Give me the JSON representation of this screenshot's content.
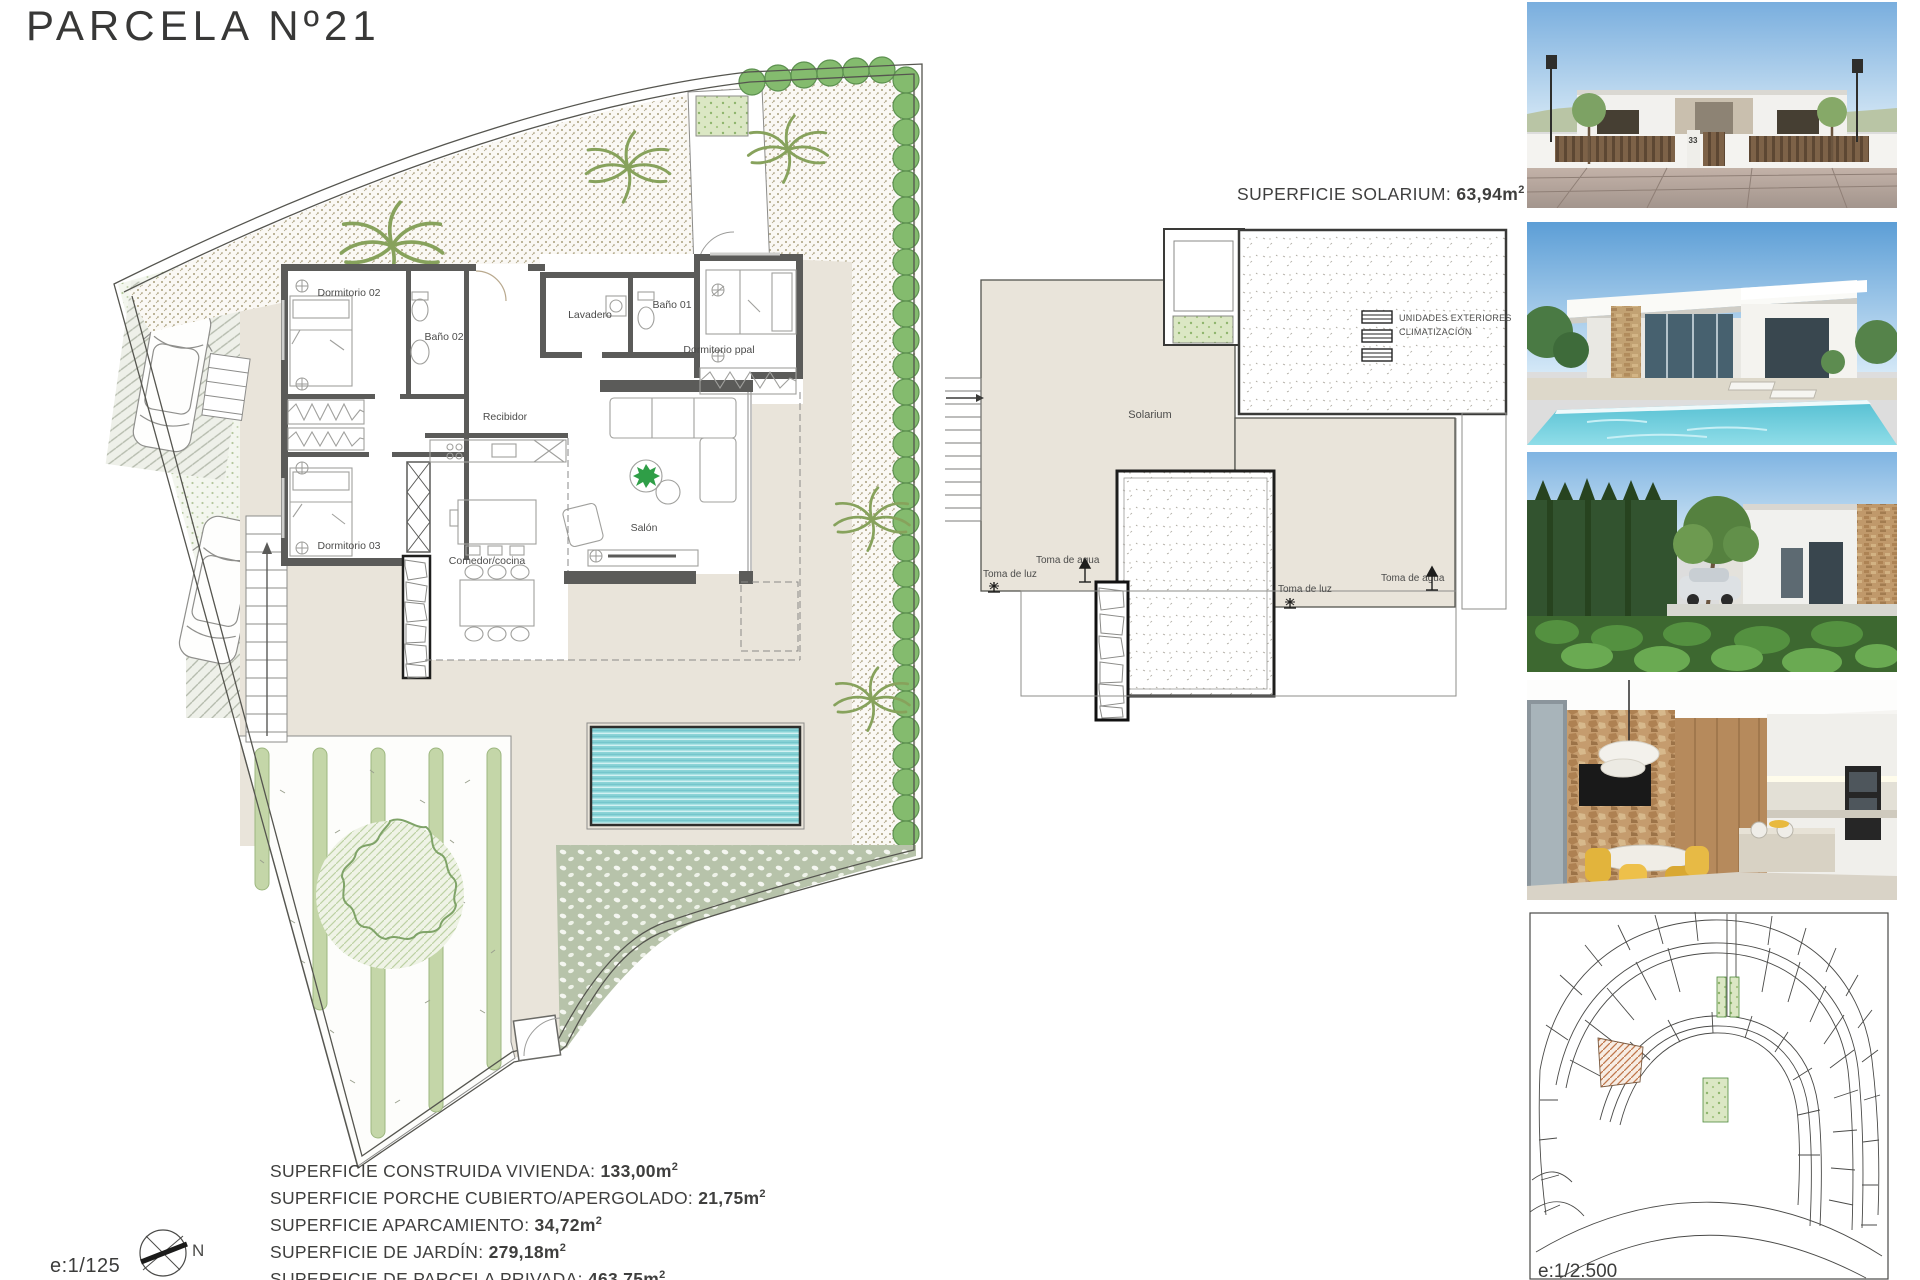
{
  "page": {
    "title": "PARCELA Nº21"
  },
  "plan": {
    "rooms": {
      "dormitorio02": "Dormitorio 02",
      "bano02": "Baño 02",
      "lavadero": "Lavadero",
      "bano01": "Baño 01",
      "dormitorio_ppal": "Dormitorio ppal",
      "recibidor": "Recibidor",
      "dormitorio03": "Dormitorio 03",
      "comedor": "Comedor/cocina",
      "salon": "Salón"
    },
    "scale": "e:1/125",
    "north": "N"
  },
  "solarium": {
    "heading_label": "SUPERFICIE SOLARIUM: ",
    "heading_value": "63,94m",
    "heading_sup": "2",
    "room": "Solarium",
    "units_line1": "UNIDADES EXTERIORES",
    "units_line2": "CLIMATIZACIÓN",
    "toma_agua": "Toma de agua",
    "toma_luz": "Toma de luz"
  },
  "surfaces": {
    "items": [
      {
        "label": "SUPERFICIE CONSTRUIDA VIVIENDA: ",
        "value": "133,00m",
        "sup": "2"
      },
      {
        "label": "SUPERFICIE PORCHE CUBIERTO/APERGOLADO: ",
        "value": "21,75m",
        "sup": "2"
      },
      {
        "label": "SUPERFICIE APARCAMIENTO: ",
        "value": "34,72m",
        "sup": "2"
      },
      {
        "label": "SUPERFICIE DE JARDÍN: ",
        "value": "279,18m",
        "sup": "2"
      },
      {
        "label": "SUPERFICIE DE PARCELA PRIVADA: ",
        "value": "463,75m",
        "sup": "2"
      }
    ]
  },
  "sitemap": {
    "scale": "e:1/2.500"
  },
  "photos": {
    "house_number": "33"
  }
}
